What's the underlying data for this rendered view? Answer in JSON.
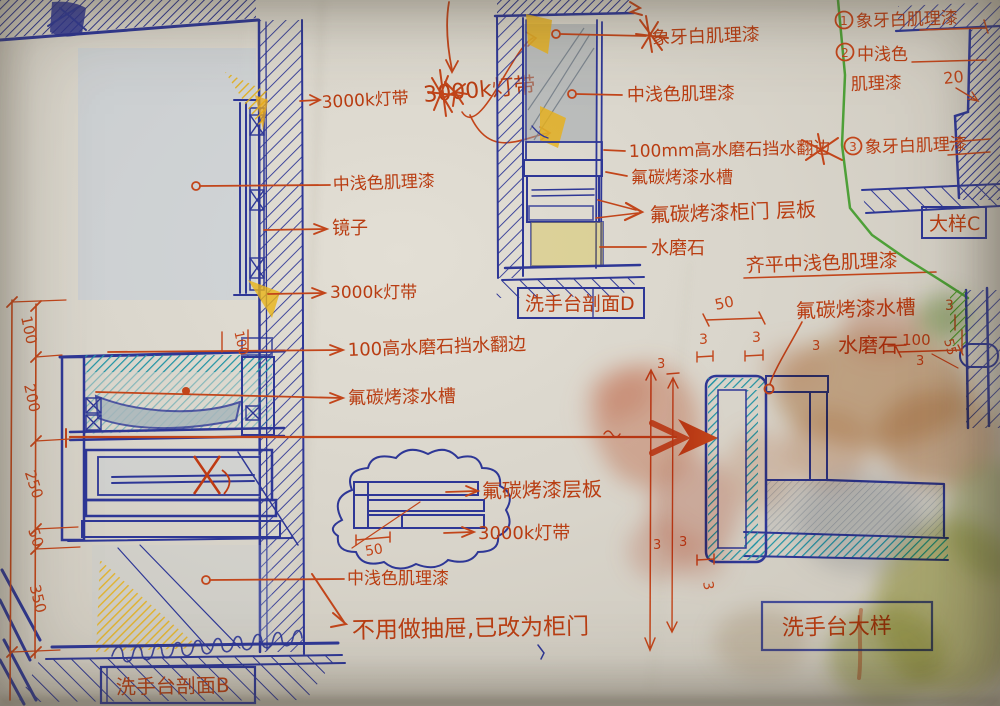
{
  "colors": {
    "pen_blue": "#2e3796",
    "pen_orange": "#c2451a",
    "marker_teal": "#1f93a4",
    "marker_green": "#4f9a27",
    "marker_yellow": "#e4ae12",
    "paper": "#d8d4ca"
  },
  "section_b": {
    "title": "洗手台剖面B",
    "labels": {
      "light_top": "3000k灯带",
      "light_big": "3000k灯带",
      "wall_paint": "中浅色肌理漆",
      "mirror": "镜子",
      "light_mid": "3000k灯带",
      "splash": "100高水磨石挡水翻边",
      "sink": "氟碳烤漆水槽",
      "cabinet_paint": "中浅色肌理漆",
      "note": "不用做抽屉,已改为柜门"
    },
    "dims": {
      "seg1": "100",
      "seg2": "200",
      "seg3": "250",
      "seg4": "50",
      "seg5": "350",
      "splash_h": "100"
    }
  },
  "shelf_callout": {
    "board": "氟碳烤漆层板",
    "light": "3000k灯带",
    "dim": "50"
  },
  "section_d": {
    "title": "洗手台剖面D",
    "labels": {
      "ivory": "象牙白肌理漆",
      "mid_tone": "中浅色肌理漆",
      "splash": "100mm高水磨石挡水翻边",
      "sink": "氟碳烤漆水槽",
      "door": "氟碳烤漆柜门 层板",
      "terrazzo": "水磨石",
      "flush": "齐平中浅色肌理漆"
    }
  },
  "detail_c": {
    "title": "大样C",
    "items": [
      {
        "num": "1",
        "text": "象牙白肌理漆"
      },
      {
        "num": "2",
        "text": "中浅色",
        "text2": "肌理漆"
      },
      {
        "num": "3",
        "text": "象牙白肌理漆"
      }
    ],
    "dim": "20"
  },
  "detail_main": {
    "title": "洗手台大样",
    "labels": {
      "sink": "氟碳烤漆水槽",
      "terrazzo": "水磨石"
    },
    "dims": {
      "top": "50",
      "top3_l": "3",
      "top3_r": "3",
      "mid3": "3",
      "left_t": "3",
      "left_b": "3",
      "left_b2": "3",
      "bottom": "3",
      "right3": "3",
      "right100": "100",
      "right55": "55",
      "under3": "3"
    }
  }
}
